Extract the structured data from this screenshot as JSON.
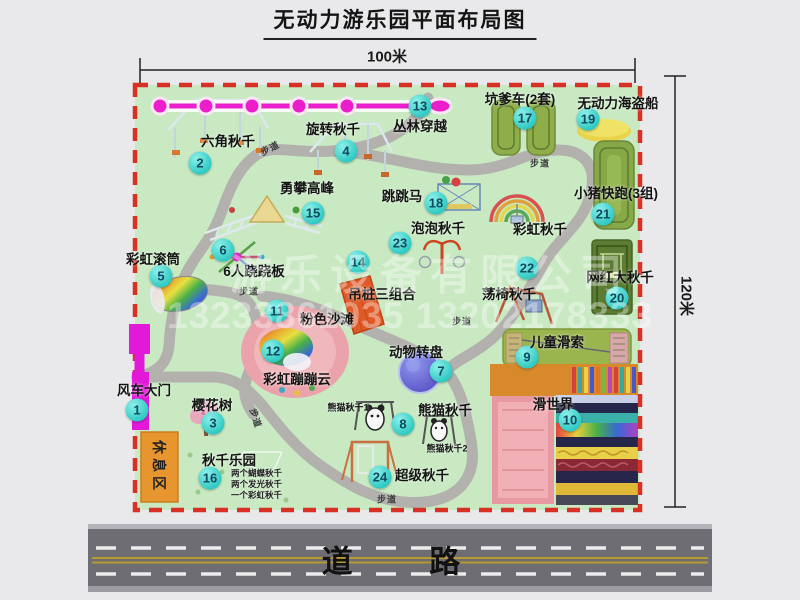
{
  "title": "无动力游乐园平面布局图",
  "dims": {
    "top": "100米",
    "right": "120米"
  },
  "road_label": "道 路",
  "walkway_label": "步道",
  "rest_area_label": "休息区",
  "rainbow_swing_label": "彩虹秋千",
  "panda_sub1": "熊猫秋千1",
  "panda_sub2": "熊猫秋千2",
  "swing_park_subs": [
    "两个蝴蝶秋千",
    "两个发光秋千",
    "一个彩虹秋千"
  ],
  "watermark": {
    "company": "游乐设备有限公司",
    "phone": "13233861035 13202178333"
  },
  "attractions": [
    {
      "num": "1",
      "label": "风车大门"
    },
    {
      "num": "2",
      "label": "六角秋千"
    },
    {
      "num": "3",
      "label": "樱花树"
    },
    {
      "num": "4",
      "label": "旋转秋千"
    },
    {
      "num": "5",
      "label": "彩虹滚筒"
    },
    {
      "num": "6",
      "label": "6人跷跷板"
    },
    {
      "num": "7",
      "label": "动物转盘"
    },
    {
      "num": "8",
      "label": "熊猫秋千"
    },
    {
      "num": "9",
      "label": "儿童滑索"
    },
    {
      "num": "10",
      "label": "滑世界"
    },
    {
      "num": "11",
      "label": "粉色沙滩"
    },
    {
      "num": "12",
      "label": "彩虹蹦蹦云"
    },
    {
      "num": "13",
      "label": "丛林穿越"
    },
    {
      "num": "14",
      "label": "吊桩三组合"
    },
    {
      "num": "15",
      "label": "勇攀高峰"
    },
    {
      "num": "16",
      "label": "秋千乐园"
    },
    {
      "num": "17",
      "label": "坑爹车(2套)"
    },
    {
      "num": "18",
      "label": "跳跳马"
    },
    {
      "num": "19",
      "label": "无动力海盗船"
    },
    {
      "num": "20",
      "label": "网红大秋千"
    },
    {
      "num": "21",
      "label": "小猪快跑(3组)"
    },
    {
      "num": "22",
      "label": "荡椅秋千"
    },
    {
      "num": "23",
      "label": "泡泡秋千"
    },
    {
      "num": "24",
      "label": "超级秋千"
    }
  ],
  "colors": {
    "map_green": "#c8e9c2",
    "border_red": "#d93025",
    "zipline_magenta": "#ea1ecb",
    "gate_magenta": "#e219d9",
    "rest_orange": "#e6952f",
    "number_cyan": "#2ec9c2",
    "road_gray": "#6d6d73"
  }
}
